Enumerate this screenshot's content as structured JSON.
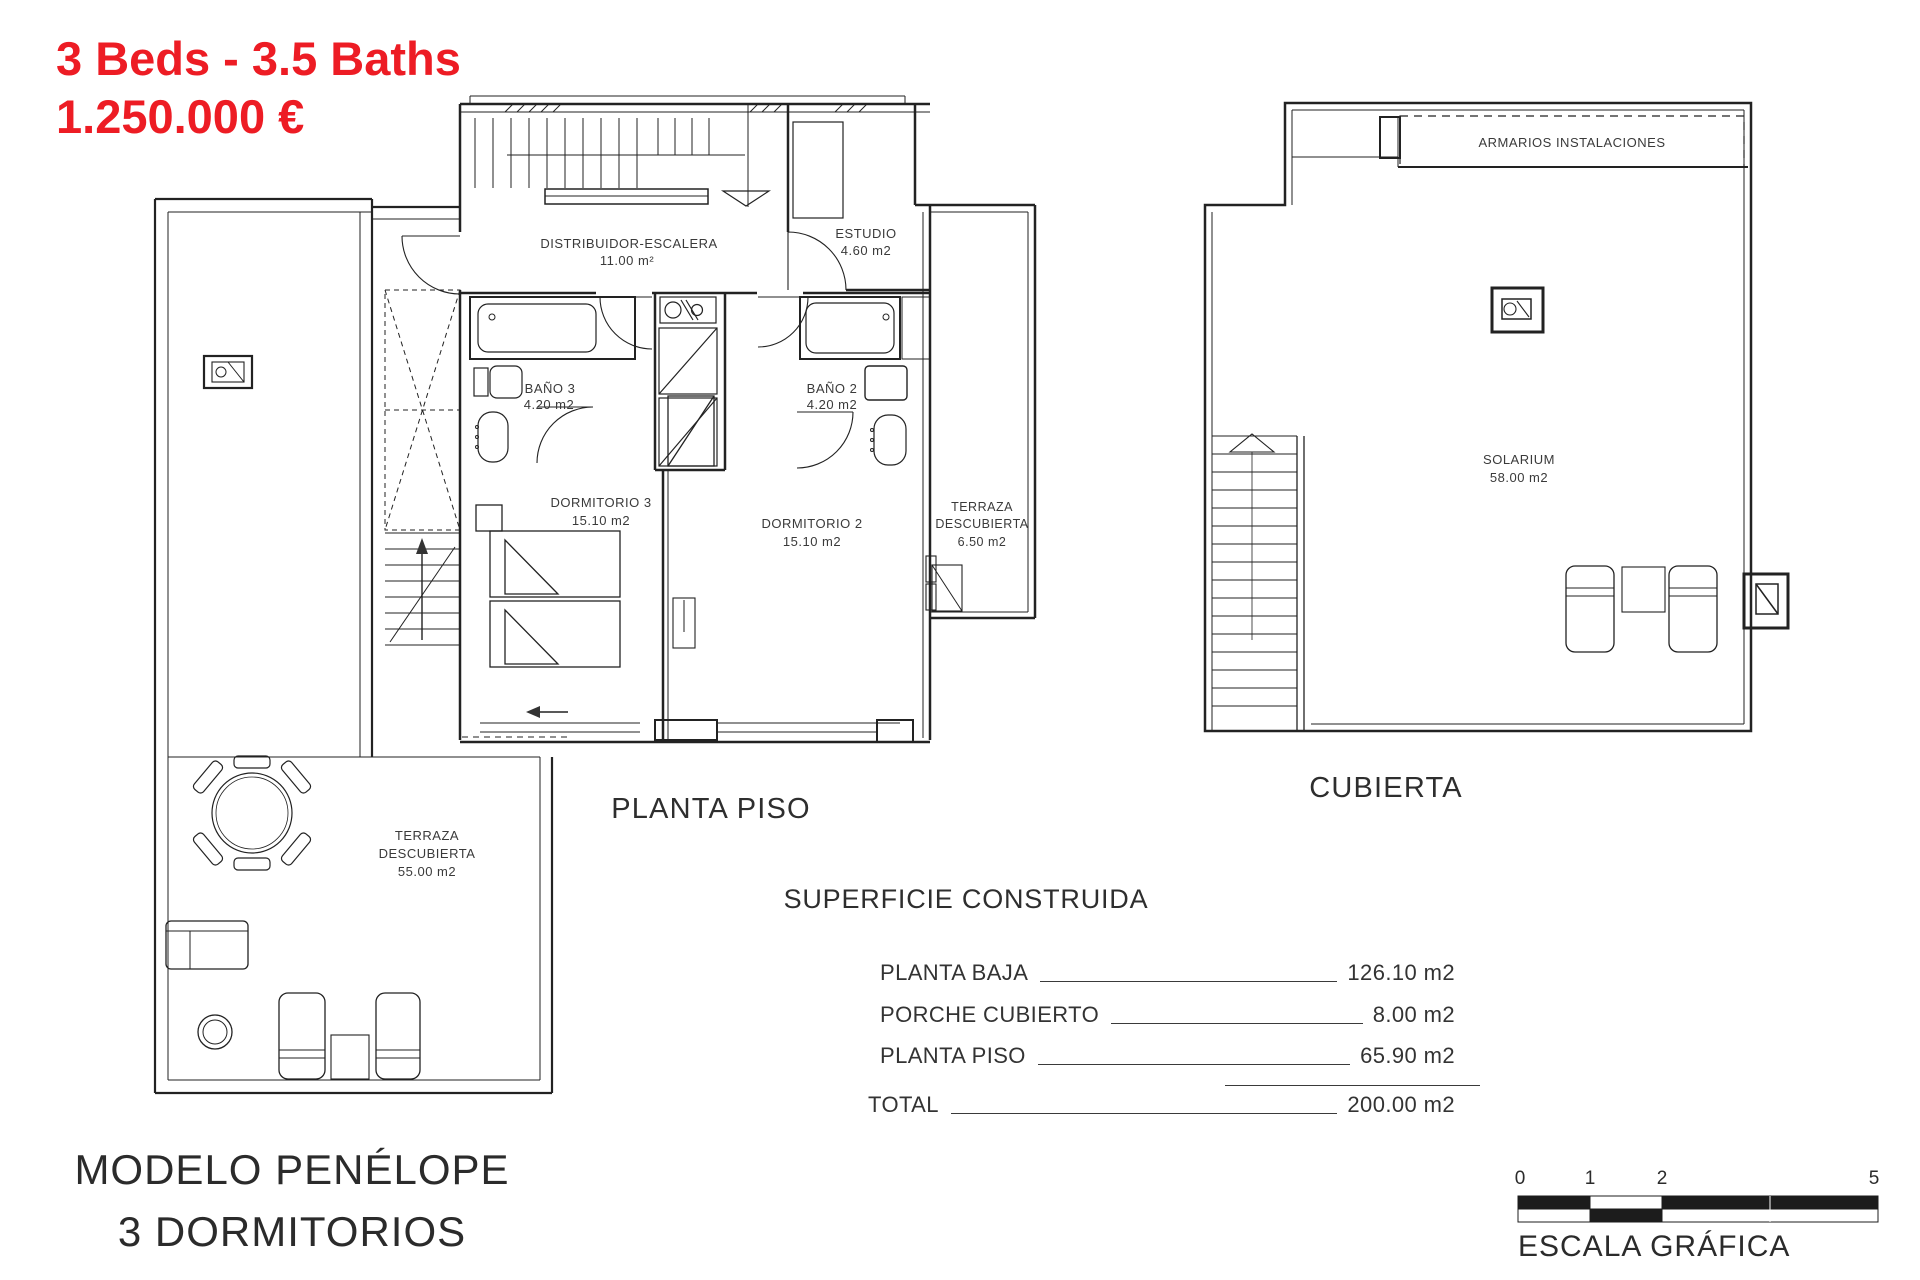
{
  "colors": {
    "accent_red": "#ed1c24",
    "ink": "#3a3a3a",
    "line": "#2b2b2b"
  },
  "header": {
    "beds_baths": "3 Beds - 3.5 Baths",
    "price": "1.250.000 €"
  },
  "floor_plan": {
    "title": "PLANTA PISO",
    "rooms": {
      "distribuidor": {
        "name": "DISTRIBUIDOR-ESCALERA",
        "area": "11.00 m²"
      },
      "estudio": {
        "name": "ESTUDIO",
        "area": "4.60 m2"
      },
      "bano3": {
        "name": "BAÑO 3",
        "area": "4.20 m2"
      },
      "bano2": {
        "name": "BAÑO 2",
        "area": "4.20 m2"
      },
      "dormitorio3": {
        "name": "DORMITORIO 3",
        "area": "15.10 m2"
      },
      "dormitorio2": {
        "name": "DORMITORIO 2",
        "area": "15.10 m2"
      },
      "terraza_lateral": {
        "line1": "TERRAZA",
        "line2": "DESCUBIERTA",
        "area": "6.50 m2"
      },
      "terraza_principal": {
        "line1": "TERRAZA",
        "line2": "DESCUBIERTA",
        "area": "55.00 m2"
      }
    }
  },
  "roof_plan": {
    "title": "CUBIERTA",
    "armarios": "ARMARIOS INSTALACIONES",
    "solarium": {
      "name": "SOLARIUM",
      "area": "58.00 m2"
    }
  },
  "surface_table": {
    "title": "SUPERFICIE CONSTRUIDA",
    "rows": [
      {
        "label": "PLANTA BAJA",
        "value": "126.10 m2"
      },
      {
        "label": "PORCHE CUBIERTO",
        "value": "8.00 m2"
      },
      {
        "label": "PLANTA PISO",
        "value": "65.90 m2"
      }
    ],
    "total": {
      "label": "TOTAL",
      "value": "200.00 m2"
    }
  },
  "model": {
    "name": "MODELO PENÉLOPE",
    "subtitle": "3 DORMITORIOS"
  },
  "scale_bar": {
    "title": "ESCALA GRÁFICA",
    "ticks": [
      "0",
      "1",
      "2",
      "5"
    ]
  }
}
